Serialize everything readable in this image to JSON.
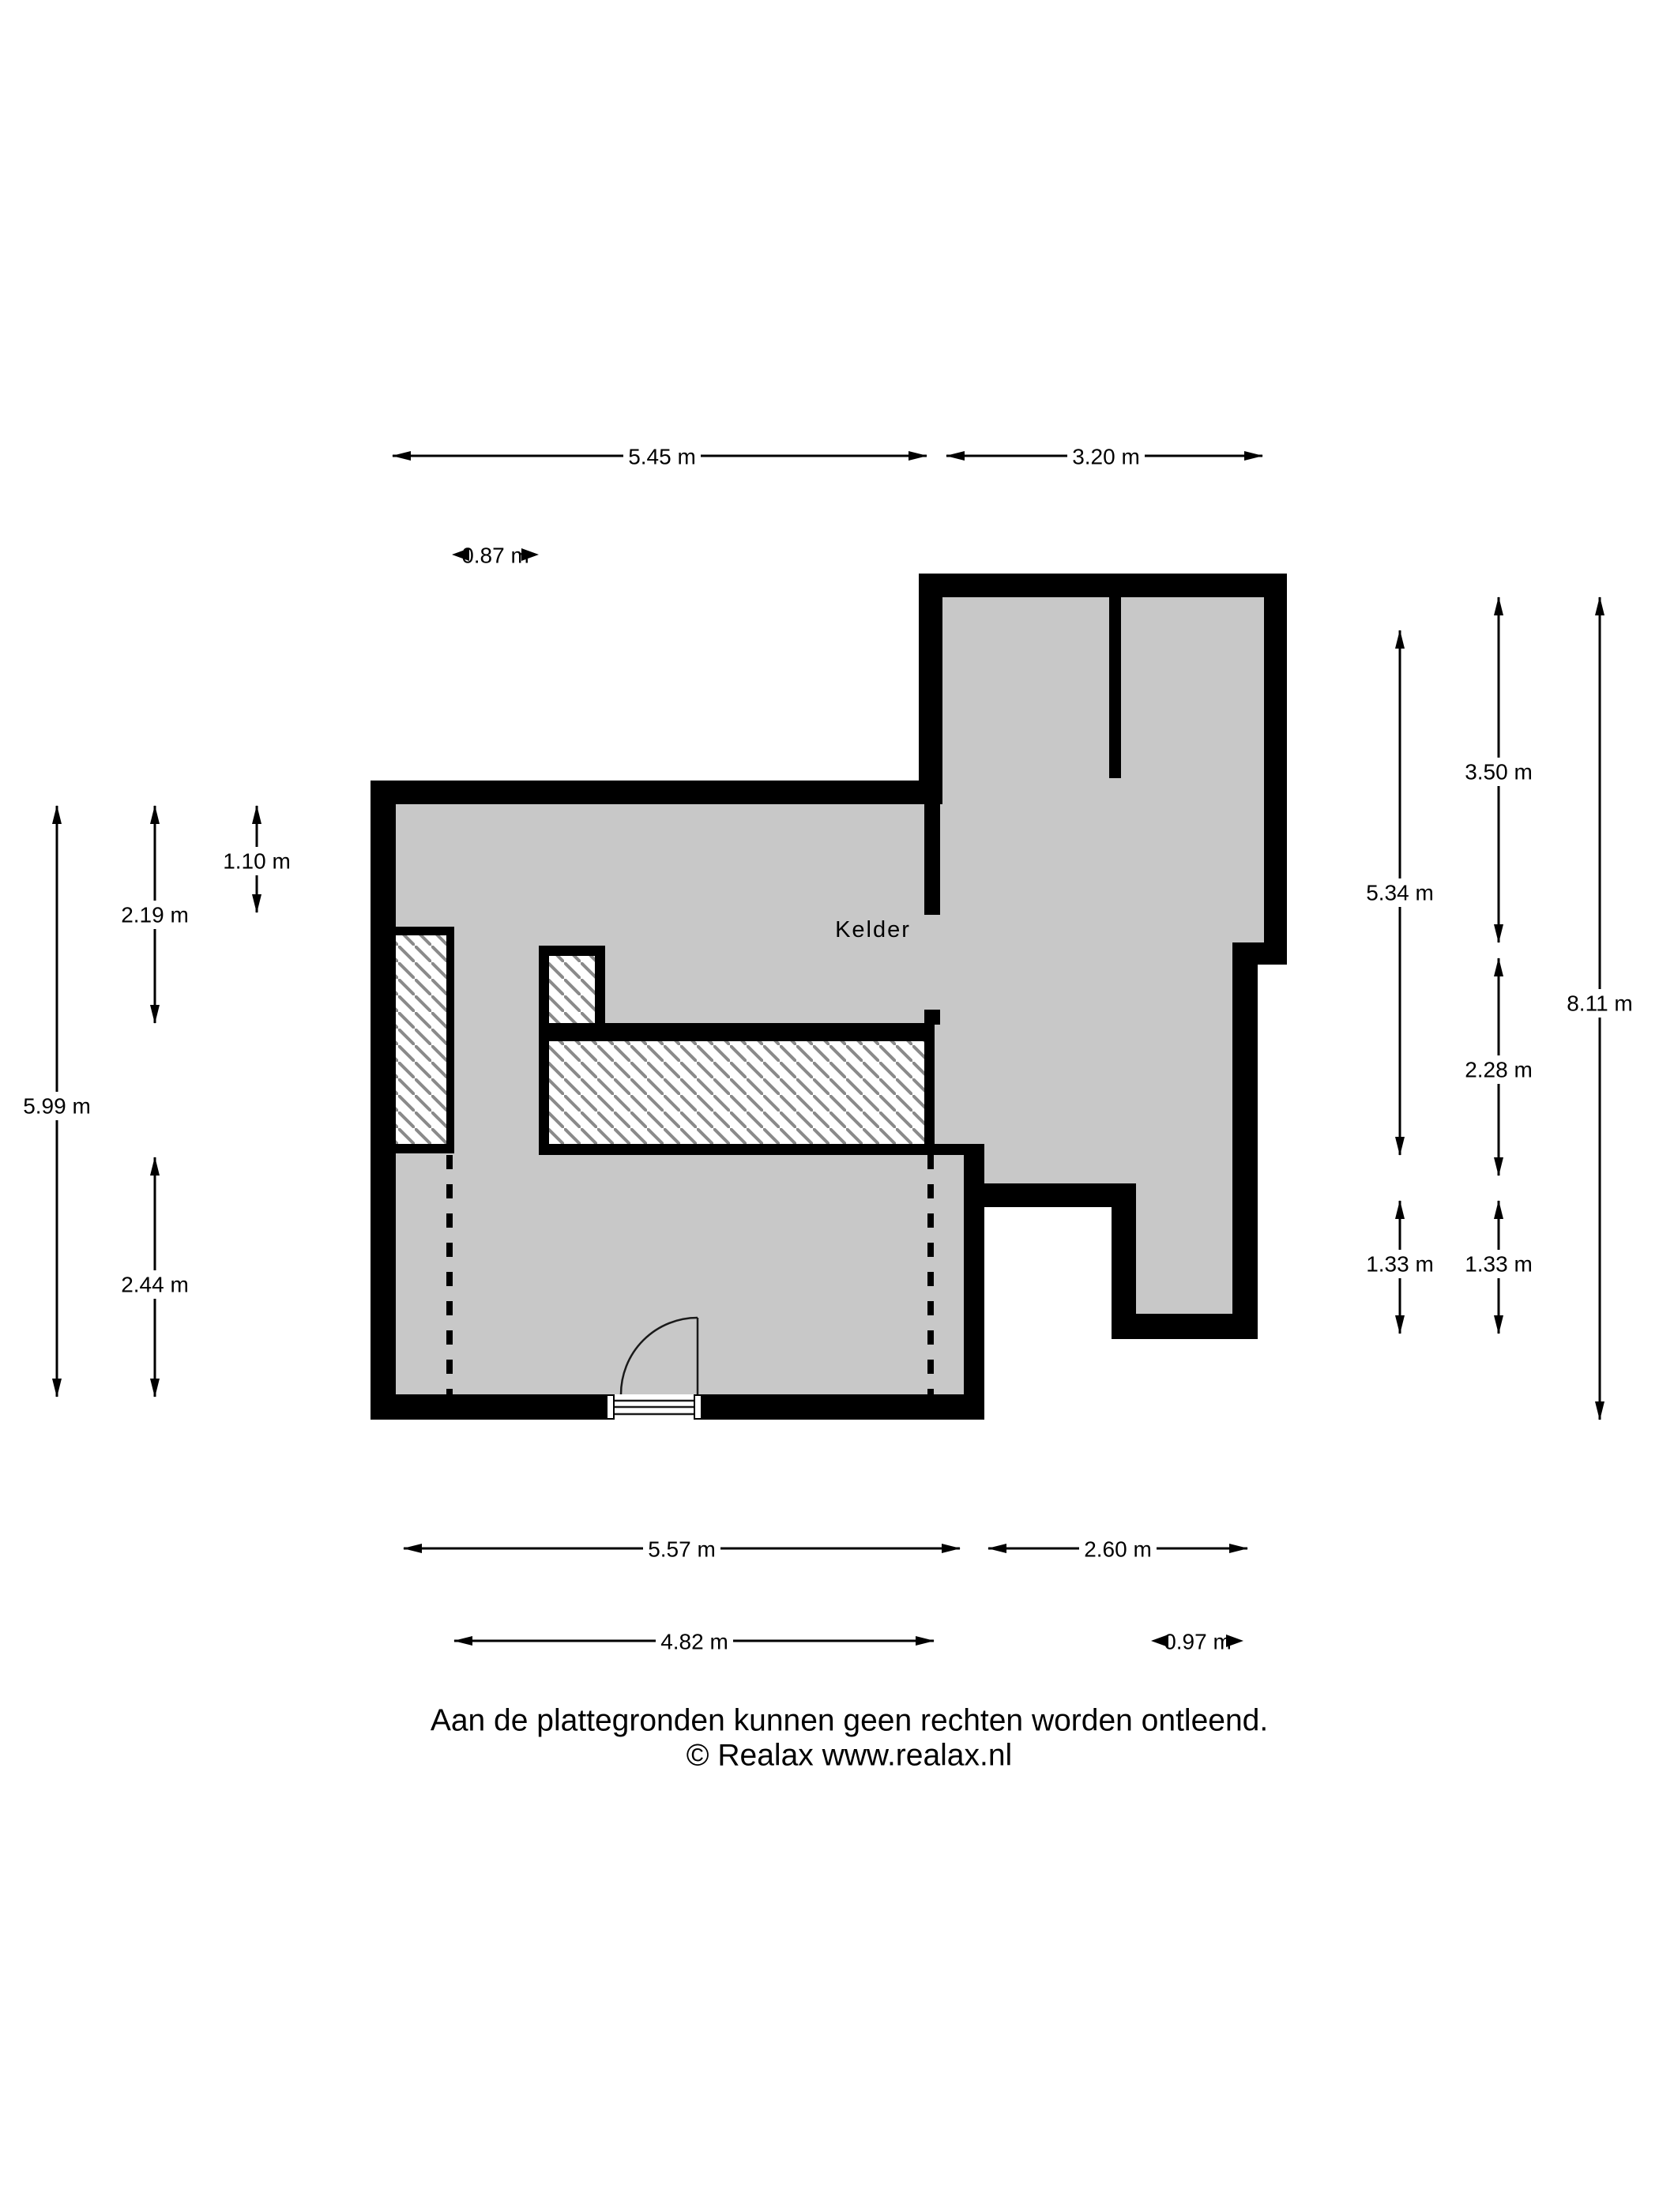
{
  "room": {
    "label": "Kelder"
  },
  "dims": {
    "top_main": "5.45 m",
    "top_right": "3.20 m",
    "gap_small": "0.87 m",
    "left_total": "5.99 m",
    "left_upper": "2.19 m",
    "left_small": "1.10 m",
    "left_lower": "2.44 m",
    "right_inner_total": "5.34 m",
    "right_inner_step": "1.33 m",
    "right_upper": "3.50 m",
    "right_mid": "2.28 m",
    "right_step": "1.33 m",
    "right_total": "8.11 m",
    "bottom_main": "5.57 m",
    "bottom_right": "2.60 m",
    "bottom_inner": "4.82 m",
    "bottom_small": "0.97 m"
  },
  "footer": {
    "line1": "Aan de plattegronden kunnen geen rechten worden ontleend.",
    "line2": "© Realax www.realax.nl"
  },
  "colors": {
    "floor": "#c8c8c8",
    "wall": "#000000",
    "hatch_line": "#8a8a8a"
  }
}
